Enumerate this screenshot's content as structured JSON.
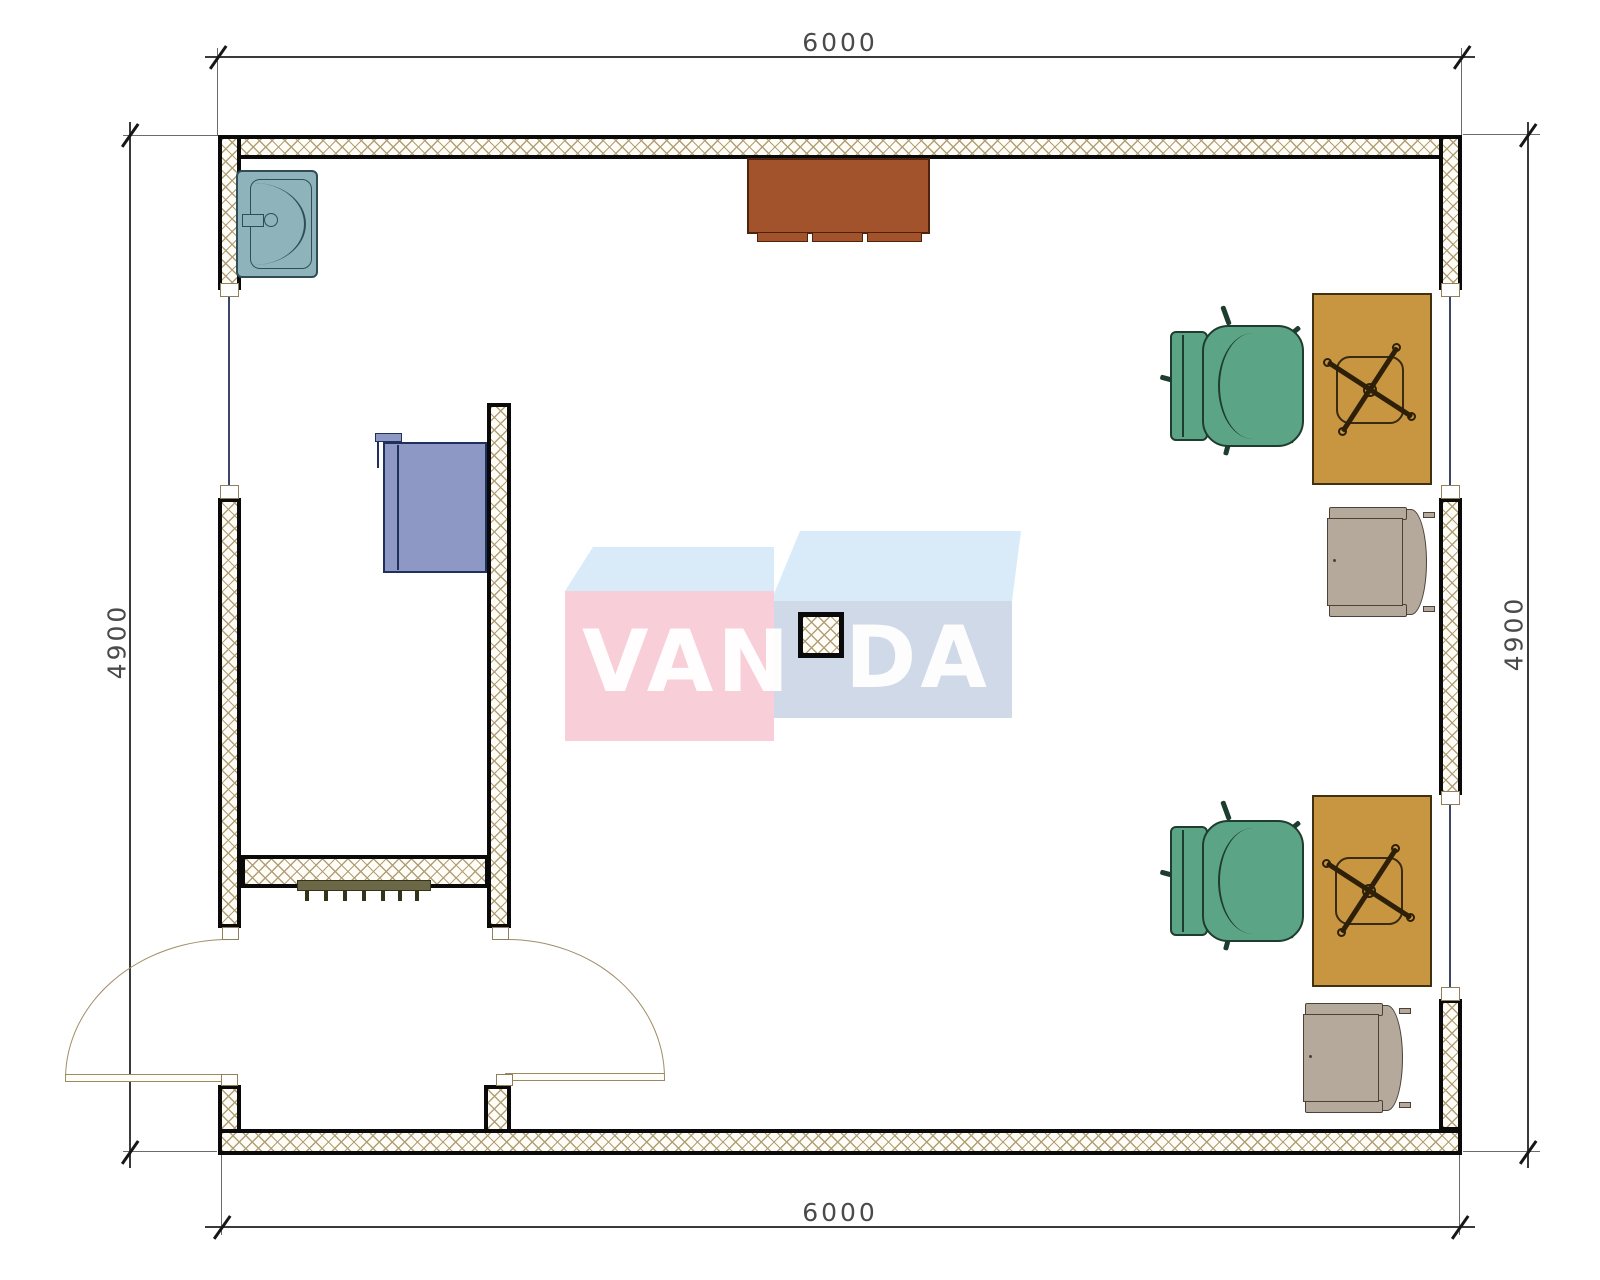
{
  "drawing": {
    "kind": "floor-plan",
    "dimensions": {
      "top": "6000",
      "bottom": "6000",
      "left": "4900",
      "right": "4900"
    },
    "watermark": {
      "part1": "VAN",
      "part2": "DA"
    },
    "colors": {
      "wall_hatch": "#b09f78",
      "wall_edge": "#0a0a0a",
      "sink": "#8fb3ba",
      "cabinet_blue": "#8d99c4",
      "table_brown": "#a3532c",
      "desk_tan": "#c89540",
      "chair_green": "#5ca486",
      "armchair_gray": "#b5a99c",
      "radiator_olive": "#6b6847",
      "watermark_pink": "#f8cfd8",
      "watermark_top_blue": "#d9eaf8",
      "watermark_front_blue": "#d0d9e7"
    },
    "furniture": [
      "sink",
      "wardrobe-cabinet",
      "wall-table",
      "radiator",
      "column",
      "desk",
      "task-chair",
      "armchair",
      "entrance-door",
      "interior-door",
      "window"
    ]
  }
}
